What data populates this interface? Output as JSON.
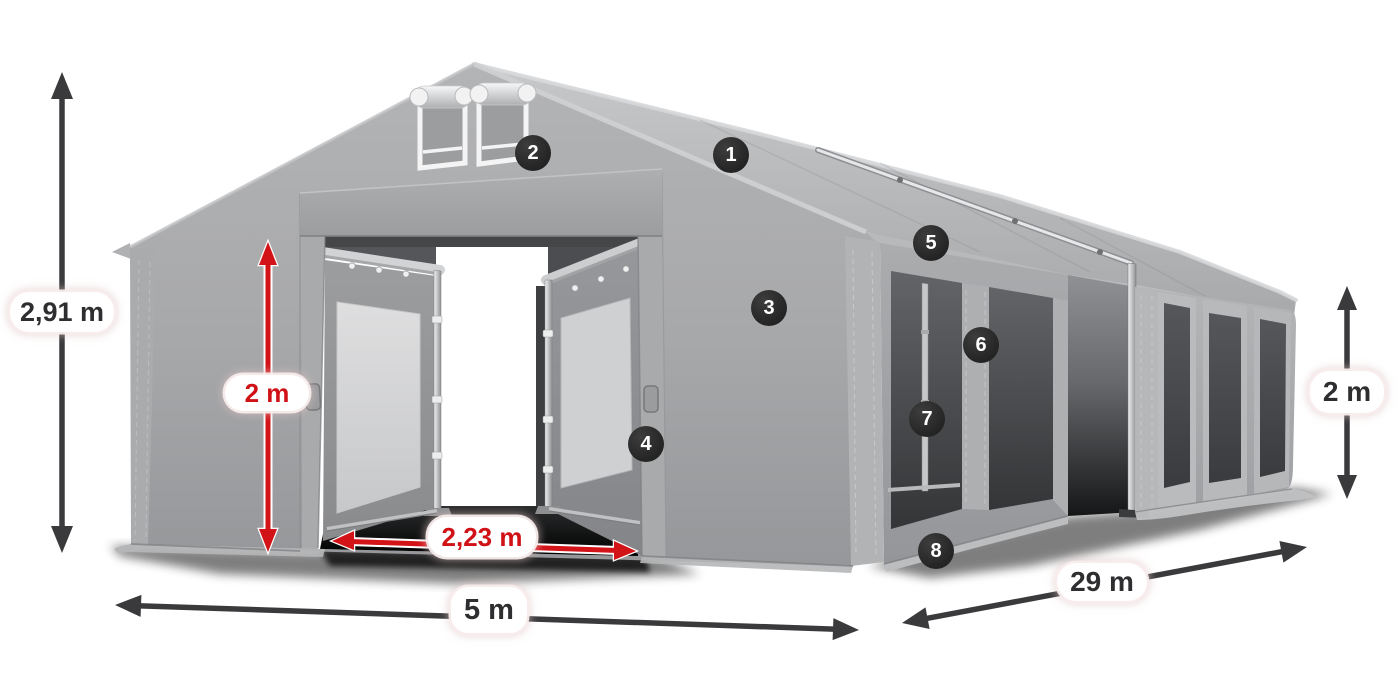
{
  "dimensions": {
    "total_height": "2,91 m",
    "door_height": "2 m",
    "door_width": "2,23 m",
    "front_width": "5 m",
    "side_length": "29 m",
    "side_height": "2 m"
  },
  "callouts": [
    {
      "number": "1"
    },
    {
      "number": "2"
    },
    {
      "number": "3"
    },
    {
      "number": "4"
    },
    {
      "number": "5"
    },
    {
      "number": "6"
    },
    {
      "number": "7"
    },
    {
      "number": "8"
    }
  ],
  "colors": {
    "dimension_arrow_dark": "#3a3a3c",
    "dimension_arrow_red": "#d21317",
    "dimension_label_bg": "#ffffff",
    "dimension_text_dark": "#2e2e30",
    "dimension_text_red": "#d01216",
    "callout_badge_bg": "#262626",
    "callout_badge_text": "#ffffff",
    "tent_fabric_gray": "#a6a7a9",
    "background": "#ffffff"
  }
}
